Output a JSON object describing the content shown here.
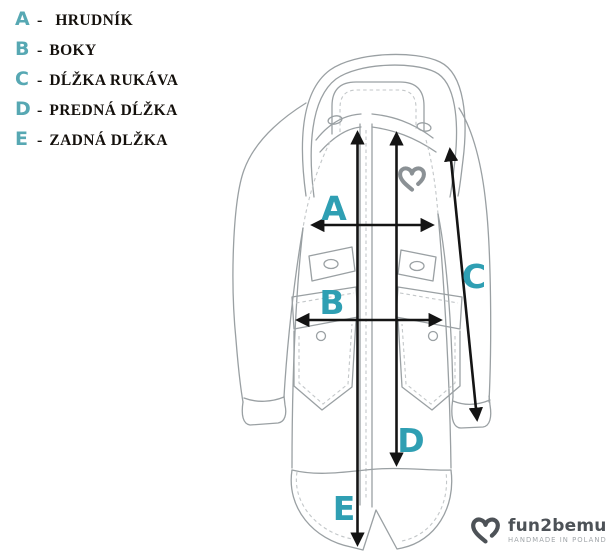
{
  "legend": {
    "separator": "-",
    "items": [
      {
        "letter": "A",
        "label": "HRUDNÍK"
      },
      {
        "letter": "B",
        "label": "BOKY"
      },
      {
        "letter": "C",
        "label": "DĹŽKA RUKÁVA"
      },
      {
        "letter": "D",
        "label": "PREDNÁ DĹŽKA"
      },
      {
        "letter": "E",
        "label": "ZADNÁ DLŽKA"
      }
    ]
  },
  "diagram": {
    "labels": {
      "a": "A",
      "b": "B",
      "c": "C",
      "d": "D",
      "e": "E"
    }
  },
  "brand": {
    "name": "fun2bemum",
    "tagline": "HANDMADE IN POLAND"
  },
  "colors": {
    "accent": "#2f9fb3",
    "legend_letter": "#57a8b3",
    "line": "#9aa0a3",
    "line_light": "#c3c7c9",
    "arrow": "#141414",
    "brand_dark": "#4d5257",
    "brand_muted": "#a1a6aa"
  }
}
